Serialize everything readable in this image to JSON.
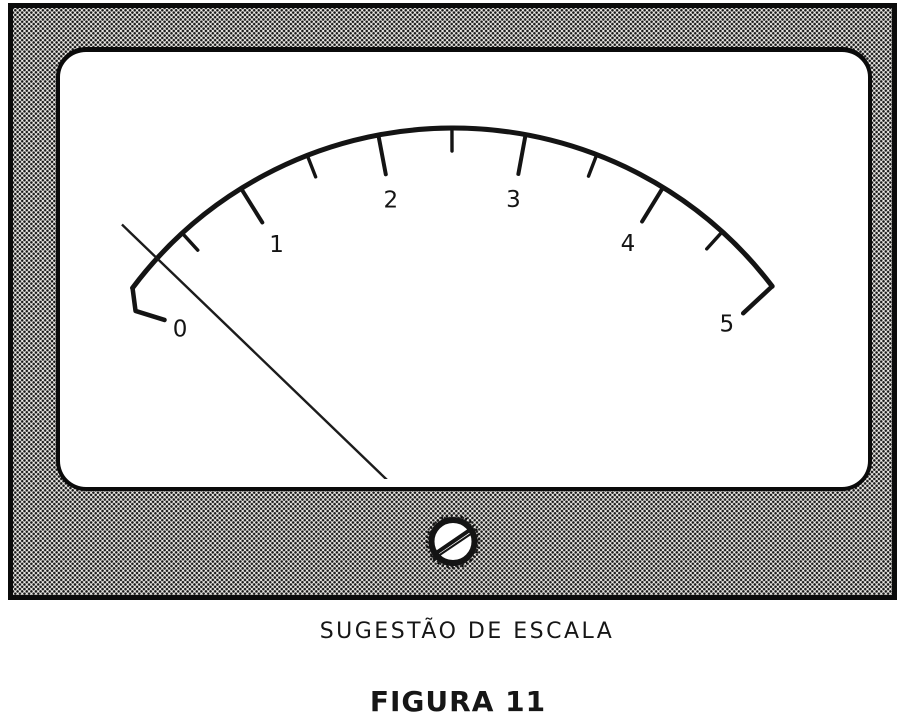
{
  "figure": {
    "caption": "SUGESTÃO DE ESCALA",
    "figure_label": "FIGURA 11"
  },
  "meter": {
    "kind": "analog-panel-meter",
    "scale": {
      "min": 0,
      "max": 5,
      "major_step": 1,
      "minor_step": 0.5,
      "major_labels": [
        "0",
        "1",
        "2",
        "3",
        "4",
        "5"
      ]
    },
    "needle_value": 0.33,
    "screw": "slotted-adjustment-screw"
  },
  "colors": {
    "ink": "#141414",
    "face": "#ffffff",
    "paper": "#ffffff"
  }
}
